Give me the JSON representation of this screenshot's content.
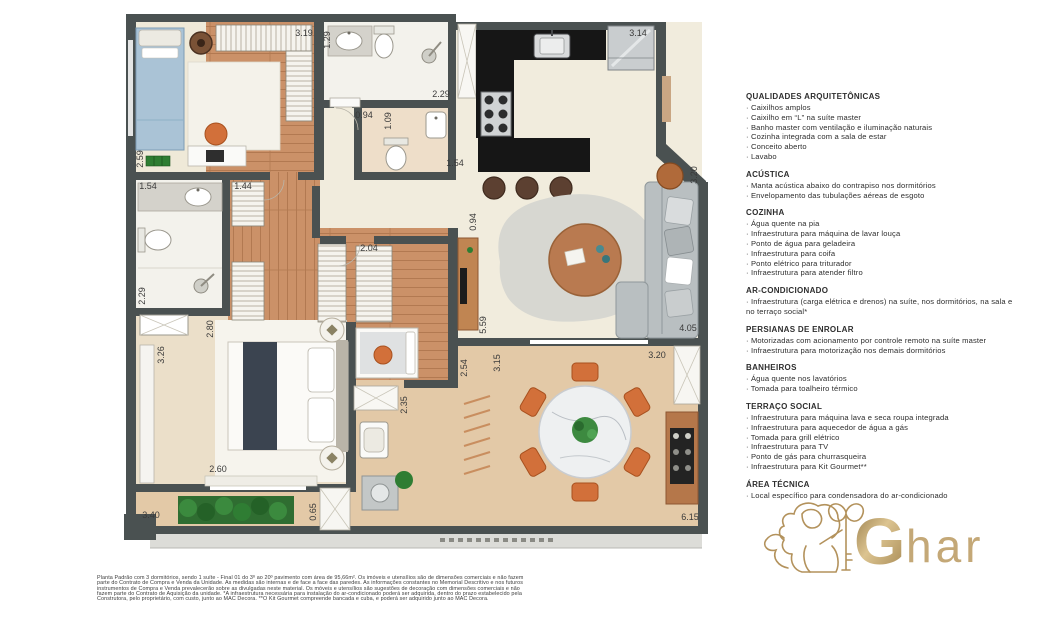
{
  "floorplan": {
    "dim_color": "#3a3a3a",
    "dimensions": [
      {
        "t": "3.19",
        "x": 304,
        "y": 36,
        "r": 0
      },
      {
        "t": "1.29",
        "x": 330,
        "y": 40,
        "r": -90
      },
      {
        "t": "2.29",
        "x": 441,
        "y": 97,
        "r": 0
      },
      {
        "t": "0.94",
        "x": 364,
        "y": 118,
        "r": 0
      },
      {
        "t": "1.09",
        "x": 391,
        "y": 121,
        "r": -90
      },
      {
        "t": "1.54",
        "x": 455,
        "y": 166,
        "r": 0
      },
      {
        "t": "3.14",
        "x": 638,
        "y": 36,
        "r": 0
      },
      {
        "t": "2.59",
        "x": 143,
        "y": 159,
        "r": -90
      },
      {
        "t": "1.54",
        "x": 148,
        "y": 189,
        "r": 0
      },
      {
        "t": "1.44",
        "x": 243,
        "y": 189,
        "r": 0
      },
      {
        "t": "2.29",
        "x": 145,
        "y": 296,
        "r": -90
      },
      {
        "t": "3.26",
        "x": 164,
        "y": 355,
        "r": -90
      },
      {
        "t": "2.80",
        "x": 213,
        "y": 329,
        "r": -90
      },
      {
        "t": "2.04",
        "x": 369,
        "y": 251,
        "r": 0
      },
      {
        "t": "0.94",
        "x": 476,
        "y": 222,
        "r": -90
      },
      {
        "t": "5.59",
        "x": 486,
        "y": 325,
        "r": -90
      },
      {
        "t": "3.20",
        "x": 697,
        "y": 175,
        "r": -90
      },
      {
        "t": "4.05",
        "x": 688,
        "y": 331,
        "r": 0
      },
      {
        "t": "3.20",
        "x": 657,
        "y": 358,
        "r": 0
      },
      {
        "t": "2.54",
        "x": 467,
        "y": 368,
        "r": -90
      },
      {
        "t": "3.15",
        "x": 500,
        "y": 363,
        "r": -90
      },
      {
        "t": "2.35",
        "x": 407,
        "y": 405,
        "r": -90
      },
      {
        "t": "2.60",
        "x": 218,
        "y": 472,
        "r": 0
      },
      {
        "t": "3.40",
        "x": 151,
        "y": 518,
        "r": 0
      },
      {
        "t": "0.65",
        "x": 316,
        "y": 512,
        "r": -90
      },
      {
        "t": "6.15",
        "x": 690,
        "y": 520,
        "r": 0
      }
    ]
  },
  "panel": {
    "bullet": "· ",
    "sections": [
      {
        "title": "QUALIDADES ARQUITETÔNICAS",
        "items": [
          "Caixilhos amplos",
          "Caixilho em “L” na suíte master",
          "Banho master com ventilação e iluminação naturais",
          "Cozinha integrada com a sala de estar",
          "Conceito aberto",
          "Lavabo"
        ]
      },
      {
        "title": "ACÚSTICA",
        "items": [
          "Manta acústica abaixo do contrapiso nos dormitórios",
          "Envelopamento das tubulações aéreas de esgoto"
        ]
      },
      {
        "title": "COZINHA",
        "items": [
          "Água quente na pia",
          "Infraestrutura para máquina de lavar louça",
          "Ponto de água para geladeira",
          "Infraestrutura para coifa",
          "Ponto elétrico para triturador",
          "Infraestrutura para atender filtro"
        ]
      },
      {
        "title": "AR-CONDICIONADO",
        "items": [
          "Infraestrutura (carga elétrica e drenos) na suíte, nos dormitórios, na sala e no terraço social*"
        ]
      },
      {
        "title": "PERSIANAS DE ENROLAR",
        "items": [
          "Motorizadas com acionamento por controle remoto na suíte master",
          "Infraestrutura para motorização nos demais dormitórios"
        ]
      },
      {
        "title": "BANHEIROS",
        "items": [
          "Água quente nos lavatórios",
          "Tomada para toalheiro térmico"
        ]
      },
      {
        "title": "TERRAÇO SOCIAL",
        "items": [
          "Infraestrutura para máquina lava e seca roupa integrada",
          "Infraestrutura para aquecedor de água a gás",
          "Tomada para grill elétrico",
          "Infraestrutura para TV",
          "Ponto de gás para churrasqueira",
          "Infraestrutura para Kit Gourmet**"
        ]
      },
      {
        "title": "ÁREA TÉCNICA",
        "items": [
          "Local específico para condensadora do ar-condicionado"
        ]
      }
    ]
  },
  "footer": {
    "lines": [
      "Planta Padrão com 3 dormitórios, sendo 1 suíte - Final 01 do 3º ao 20º pavimento com área de 95,66m². Os imóveis e utensílios são de dimensões comerciais e não fazem",
      "parte do Contrato de Compra e Venda da Unidade. As medidas são internas e de face a face das paredes. As informações constantes no Memorial Descritivo e nos futuros",
      "instrumentos de Compra e Venda prevalecerão sobre as divulgadas neste material. Os móveis e utensílios são sugestões de decoração com dimensões comerciais e não",
      "fazem parte do Contrato de Aquisição da unidade. *A infraestrutura necessária para instalação do ar-condicionado poderá ser adquirida, dentro do prazo estabelecido pela",
      "Construtora, pelo proprietário, com custo, junto ao MAC Decora. **O Kit Gourmet compreende bancada e cuba, e poderá ser adquirido junto ao MAC Decora."
    ]
  },
  "logo": {
    "g": "G",
    "rest": "har",
    "gold": "#b3925c"
  }
}
